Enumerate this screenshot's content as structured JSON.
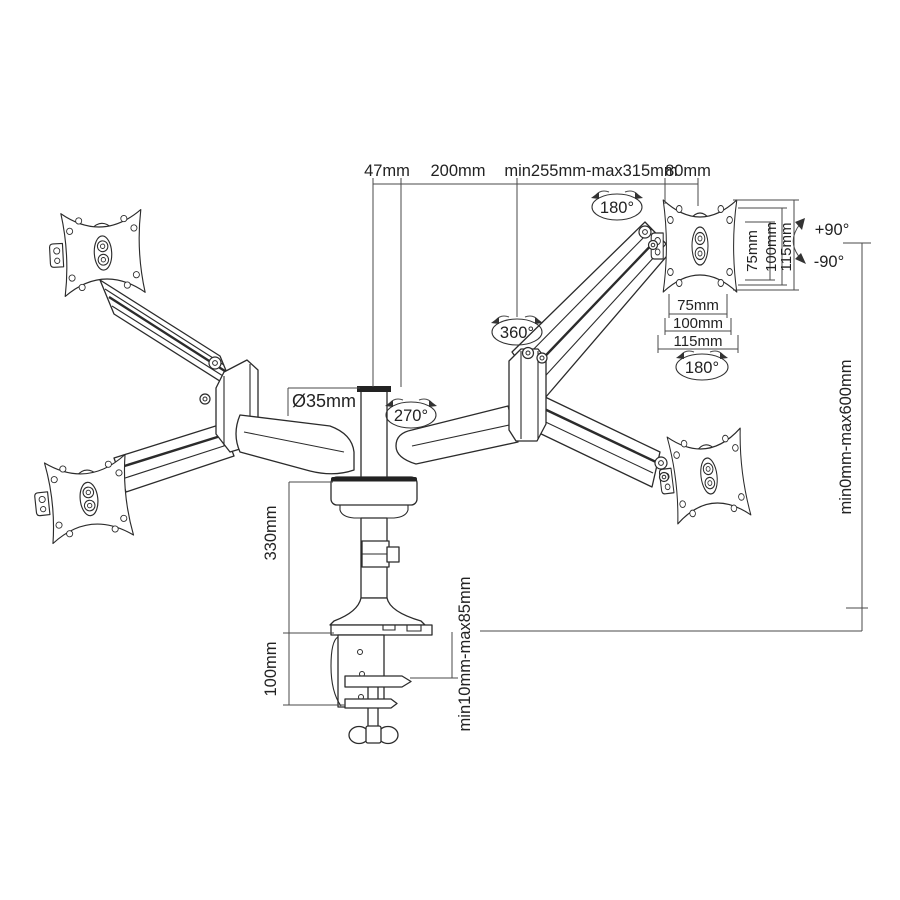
{
  "figure": {
    "background": "#ffffff",
    "ink": "#2b2b2b",
    "dim_color": "#4a4a4a"
  },
  "labels": {
    "top_dims": {
      "pole_offset": "47mm",
      "arm_front": "200mm",
      "arm_range": "min255mm-max315mm",
      "vesa_depth": "80mm"
    },
    "rotations": {
      "upper_arm_swivel": "180°",
      "elbow_swivel": "360°",
      "base_swivel": "270°",
      "vesa_rotate": "180°"
    },
    "pole": {
      "diameter": "Ø35mm",
      "column_height": "330mm",
      "clamp_height": "100mm"
    },
    "vesa_dims": {
      "vertical": [
        "75mm",
        "100mm",
        "115mm"
      ],
      "horizontal": [
        "75mm",
        "100mm",
        "115mm"
      ]
    },
    "tilt": {
      "up": "+90°",
      "down": "-90°"
    },
    "ranges": {
      "height_adjust": "min0mm-max600mm",
      "desk_thickness": "min10mm-max85mm"
    }
  }
}
